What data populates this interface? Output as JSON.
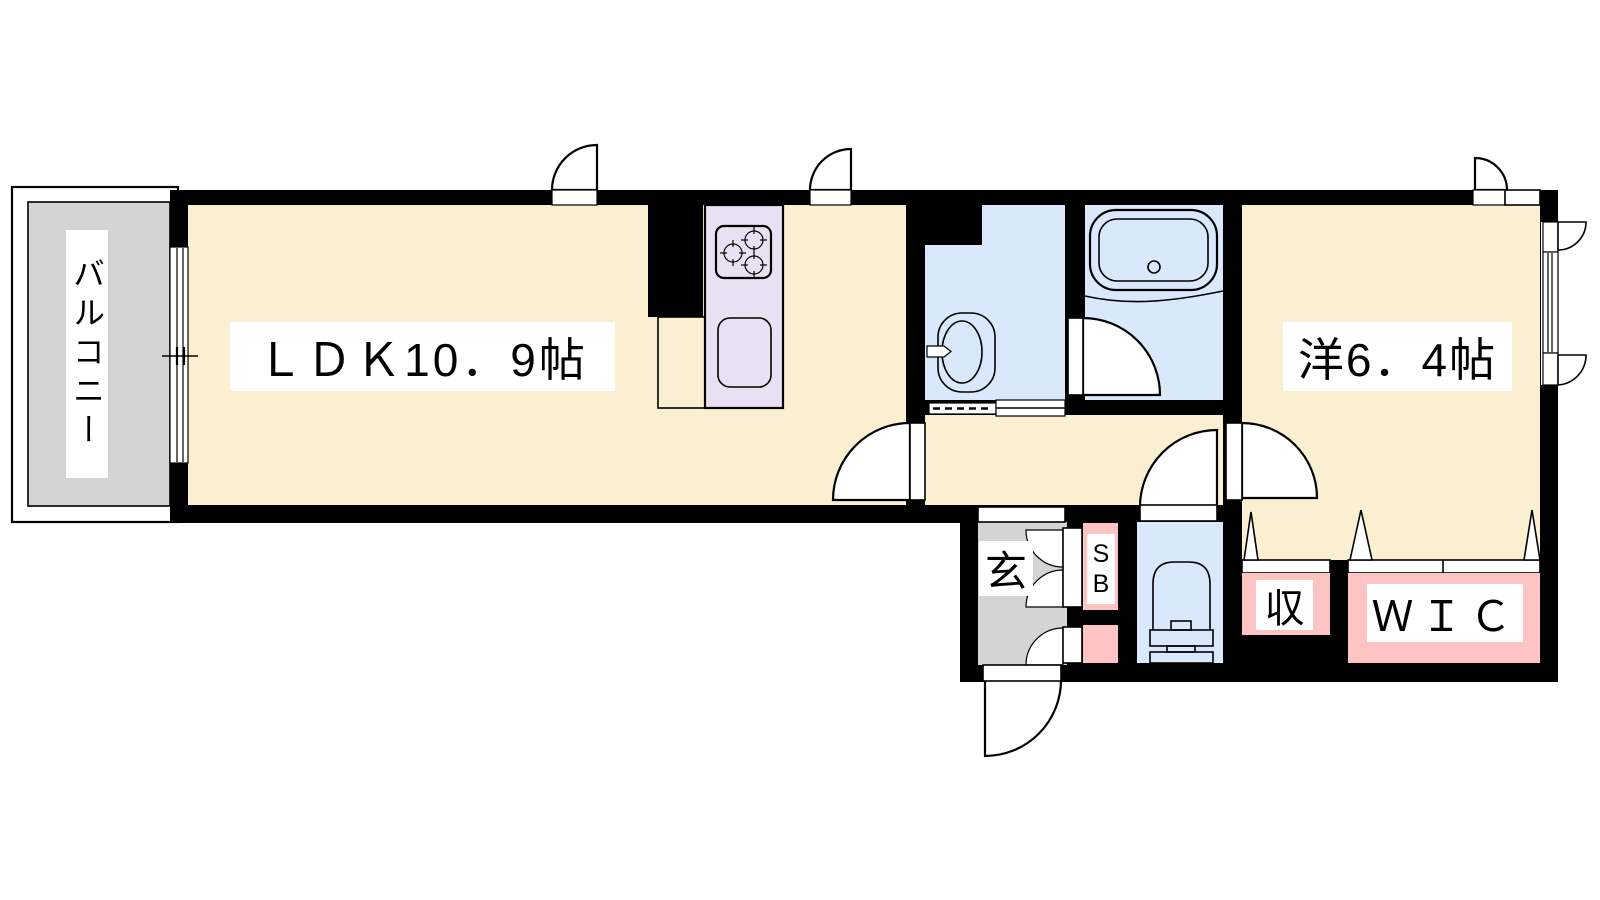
{
  "floor_plan": {
    "rooms": {
      "balcony": {
        "label": "バルコニー"
      },
      "ldk": {
        "label": "ＬＤＫ10．9帖"
      },
      "western_room": {
        "label": "洋6．4帖"
      },
      "entrance": {
        "label": "玄"
      },
      "shoe_box": {
        "line1": "S",
        "line2": "B"
      },
      "storage": {
        "label": "収"
      },
      "walk_in_closet": {
        "label": "ＷＩＣ"
      }
    },
    "fixtures": {
      "kitchen_stove": "gas-stove-3-burner-icon",
      "kitchen_sink": "kitchen-sink-icon",
      "wash_basin": "wash-basin-icon",
      "bathtub": "bathtub-icon",
      "toilet": "toilet-icon"
    },
    "colors": {
      "room_floor": "#FAEFD0",
      "kitchen_counter": "#EAE0F3",
      "wet_area": "#D9E8FA",
      "closet": "#FEC3C3",
      "balcony_entrance_gray": "#D4D4D4",
      "wall": "#000000",
      "background": "#FFFFFF",
      "label_background": "#FFFFFF",
      "text": "#000000"
    }
  }
}
